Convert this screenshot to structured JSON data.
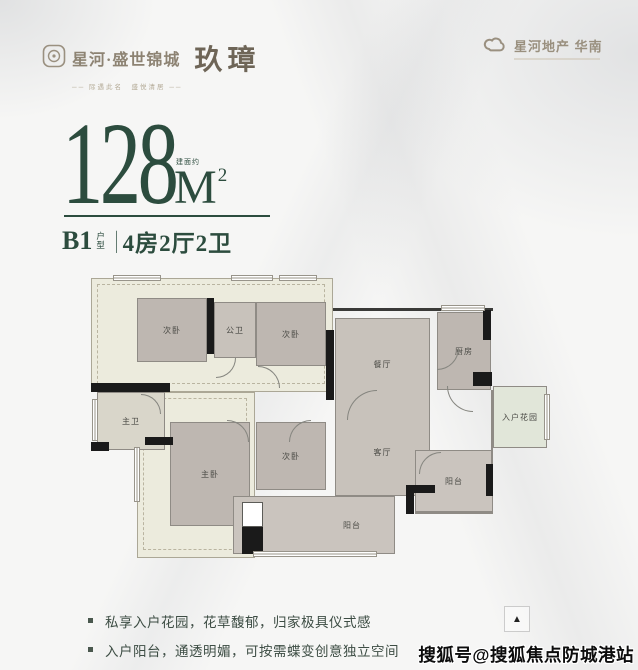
{
  "brand": {
    "left": {
      "name": "星河·盛世锦城",
      "emblem": "玖璋",
      "tagline": "── 际遇此名　盛悦清居 ──"
    },
    "right": {
      "name": "星河地产",
      "region": "华南"
    }
  },
  "headline": {
    "area": "128",
    "area_note": "建面约",
    "unit": "M",
    "unit_sup": "2",
    "plan_code": "B1",
    "plan_note_chars": [
      "户",
      "型"
    ],
    "separator": "|",
    "layout": "4房2厅2卫"
  },
  "floorplan": {
    "rooms": [
      {
        "id": "bedroom-2a",
        "label": "次卧"
      },
      {
        "id": "bath-public",
        "label": "公卫"
      },
      {
        "id": "bedroom-2b",
        "label": "次卧"
      },
      {
        "id": "dining",
        "label": "餐厅"
      },
      {
        "id": "kitchen",
        "label": "厨房"
      },
      {
        "id": "entry-garden",
        "label": "入户花园"
      },
      {
        "id": "living",
        "label": "客厅"
      },
      {
        "id": "balcony-side",
        "label": "阳台"
      },
      {
        "id": "bedroom-2c",
        "label": "次卧"
      },
      {
        "id": "bedroom-master",
        "label": "主卧"
      },
      {
        "id": "bath-master",
        "label": "主卫"
      },
      {
        "id": "balcony-main",
        "label": "阳台"
      }
    ],
    "compass_glyph": "▲"
  },
  "features": [
    "私享入户花园，花草馥郁，归家极具仪式感",
    "入户阳台，通透明媚，可按需蝶变创意独立空间"
  ],
  "watermark": "搜狐号@搜狐焦点防城港站",
  "colors": {
    "brand_green": "#2c4c3e",
    "logo_taupe": "#8d8373",
    "wall_black": "#1a1a1a",
    "room_fill": "#beb7b1",
    "cream_fill": "#ecebdd",
    "garden_green": "#e1e6d9",
    "feature_text": "#3d4d44"
  }
}
